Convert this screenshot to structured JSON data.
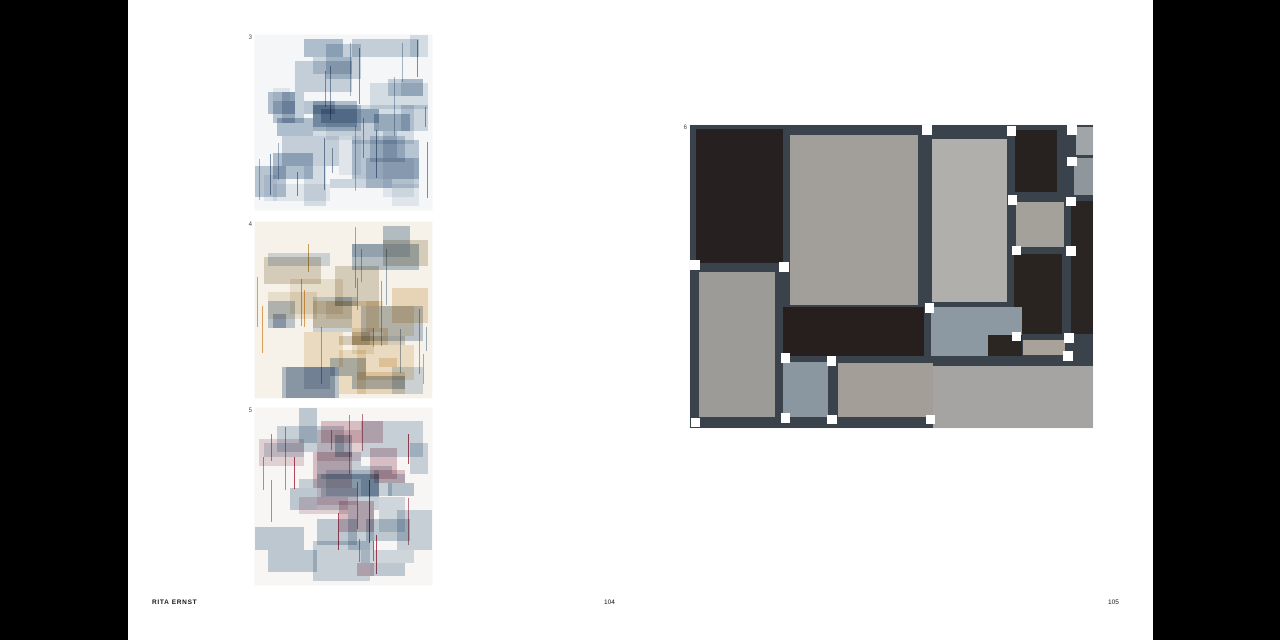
{
  "page": {
    "background": "#000000",
    "spread_background": "#ffffff",
    "footer": {
      "artist": "RITA ERNST",
      "left_page_number": "104",
      "right_page_number": "105"
    }
  },
  "artworks": [
    {
      "label": "3",
      "frame": {
        "left": 255,
        "top": 35,
        "width": 177,
        "height": 175
      },
      "style": "generated",
      "bg": "#f4f6f7",
      "seed": 9001,
      "rect_count": 42,
      "line_count": 18,
      "palette": [
        "#dde4eb",
        "#ccd6e0",
        "#c0ccd9",
        "#e9eef2",
        "#ffffff",
        "#b6c5d4",
        "#d4dde6"
      ],
      "line_colors": [
        "#8da2b6",
        "#a9bac9",
        "#7f93a8"
      ]
    },
    {
      "label": "4",
      "frame": {
        "left": 255,
        "top": 222,
        "width": 177,
        "height": 176
      },
      "style": "generated",
      "bg": "#f6f2ea",
      "seed": 4242,
      "rect_count": 40,
      "line_count": 16,
      "palette": [
        "#d3dce5",
        "#c2cdd9",
        "#f0e0c8",
        "#efe9dc",
        "#ffffff",
        "#dcd6c9",
        "#b9c5d2",
        "#f3e7d2"
      ],
      "line_colors": [
        "#e2a85e",
        "#9eafc0",
        "#caa36a"
      ]
    },
    {
      "label": "5",
      "frame": {
        "left": 255,
        "top": 408,
        "width": 177,
        "height": 177
      },
      "style": "generated",
      "bg": "#f7f6f4",
      "seed": 5150,
      "rect_count": 42,
      "line_count": 16,
      "palette": [
        "#cdd7e0",
        "#bac7d3",
        "#e9d8dd",
        "#dfc5cc",
        "#ffffff",
        "#d6dee5",
        "#c3cfda"
      ],
      "line_colors": [
        "#b44b5c",
        "#8da0b2",
        "#c67a88"
      ]
    },
    {
      "label": "6",
      "frame": {
        "left": 690,
        "top": 125,
        "width": 403,
        "height": 303
      },
      "style": "explicit",
      "bg": "#3a424b",
      "gap_color": "#ffffff",
      "gap_w": 2.4,
      "gap_h": 3.2,
      "cells": [
        {
          "x": 1.5,
          "y": 1.2,
          "w": 21.5,
          "h": 44.3,
          "c": "#262120",
          "dots": true
        },
        {
          "x": 24.8,
          "y": 3.2,
          "w": 31.8,
          "h": 56.3,
          "c": "#a29f9a"
        },
        {
          "x": 60.1,
          "y": 4.5,
          "w": 18.6,
          "h": 54.0,
          "c": "#b1afac"
        },
        {
          "x": 80.6,
          "y": 1.5,
          "w": 10.5,
          "h": 20.5,
          "c": "#272220"
        },
        {
          "x": 95.9,
          "y": 0.8,
          "w": 4.1,
          "h": 9.0,
          "c": "#9fa5a9"
        },
        {
          "x": 95.3,
          "y": 11.0,
          "w": 4.7,
          "h": 12.0,
          "c": "#8f969c"
        },
        {
          "x": 80.9,
          "y": 25.5,
          "w": 11.9,
          "h": 14.8,
          "c": "#a4a09a"
        },
        {
          "x": 80.3,
          "y": 42.5,
          "w": 11.9,
          "h": 26.5,
          "c": "#2a2421"
        },
        {
          "x": 94.6,
          "y": 25.0,
          "w": 5.4,
          "h": 44.0,
          "c": "#2a2522"
        },
        {
          "x": 2.2,
          "y": 48.5,
          "w": 19.0,
          "h": 48.0,
          "c": "#9d9b97"
        },
        {
          "x": 23.2,
          "y": 60.0,
          "w": 34.8,
          "h": 16.3,
          "c": "#261f1d"
        },
        {
          "x": 59.8,
          "y": 60.0,
          "w": 22.5,
          "h": 16.3,
          "c": "#8c99a2"
        },
        {
          "x": 74.0,
          "y": 69.3,
          "w": 8.3,
          "h": 7.0,
          "c": "#2c2623"
        },
        {
          "x": 82.7,
          "y": 70.8,
          "w": 10.4,
          "h": 5.0,
          "c": "#a8a298"
        },
        {
          "x": 23.2,
          "y": 78.3,
          "w": 11.1,
          "h": 18.2,
          "c": "#8b97a0"
        },
        {
          "x": 36.8,
          "y": 78.6,
          "w": 23.5,
          "h": 17.9,
          "c": "#a39f98"
        },
        {
          "x": 60.2,
          "y": 79.6,
          "w": 39.8,
          "h": 20.4,
          "c": "#a6a4a2"
        }
      ],
      "gaps": [
        {
          "x": 0.0,
          "y": 44.6
        },
        {
          "x": 22.2,
          "y": 45.2
        },
        {
          "x": 57.6,
          "y": 0.0
        },
        {
          "x": 78.6,
          "y": 0.4
        },
        {
          "x": 93.6,
          "y": 0.0
        },
        {
          "x": 93.6,
          "y": 10.4
        },
        {
          "x": 78.8,
          "y": 23.2
        },
        {
          "x": 93.4,
          "y": 23.6
        },
        {
          "x": 79.8,
          "y": 39.8
        },
        {
          "x": 93.4,
          "y": 40.0
        },
        {
          "x": 58.2,
          "y": 58.8
        },
        {
          "x": 22.5,
          "y": 75.2
        },
        {
          "x": 33.9,
          "y": 76.2
        },
        {
          "x": 79.8,
          "y": 68.2
        },
        {
          "x": 92.8,
          "y": 68.6
        },
        {
          "x": 92.6,
          "y": 74.6
        },
        {
          "x": 22.5,
          "y": 95.2
        },
        {
          "x": 34.0,
          "y": 95.6
        },
        {
          "x": 58.5,
          "y": 95.6
        },
        {
          "x": 0.2,
          "y": 96.6
        }
      ]
    }
  ]
}
